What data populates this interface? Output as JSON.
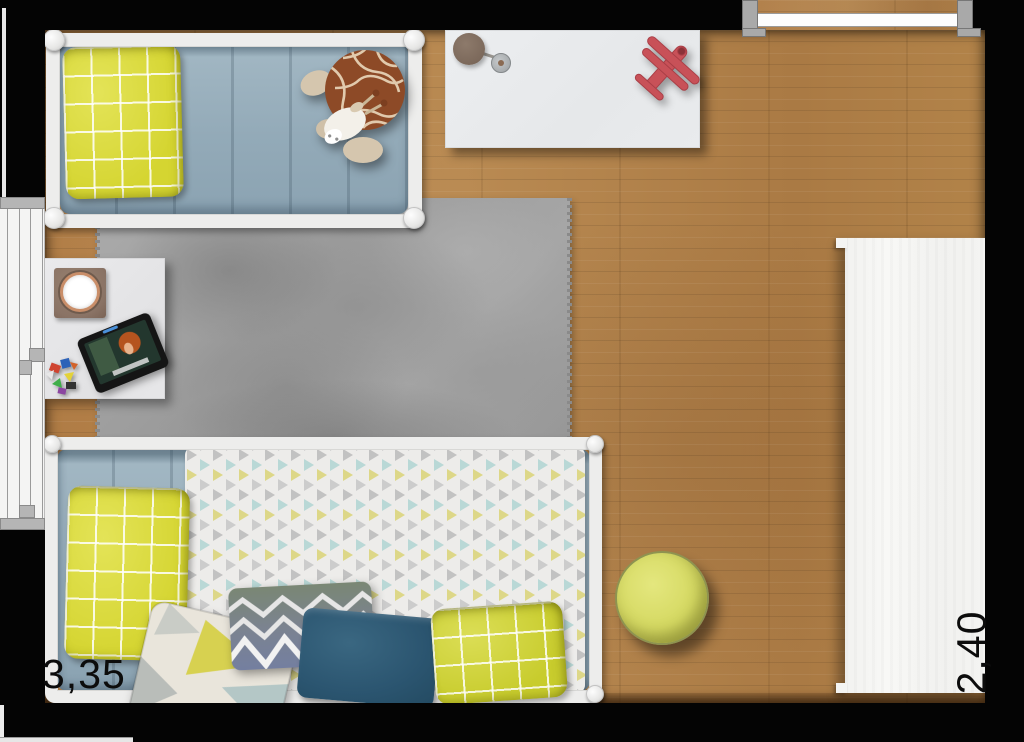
{
  "labels": {
    "room_width": "3,35",
    "room_depth": "2,40"
  },
  "palette": {
    "wall": "#040404",
    "floor_wood": "#b2814a",
    "rug_gray": "#a2a2a2",
    "bed_frame_white": "#ededec",
    "bedding_blue": "#93aab8",
    "pillow_yellow": "#d5d531",
    "pillow_navy": "#2d5670",
    "duvet_triangle_base": "#edecea",
    "triangle_gray": "#c2c2c2",
    "triangle_yellow": "#ddd788",
    "triangle_blue": "#b9d8d6",
    "pouf_yellow": "#d5d962",
    "furniture_white": "#eceef0",
    "wardrobe_white": "#f4f4f2",
    "airplane_red": "#c85158",
    "lamp_shade_brown": "#7c695b",
    "giraffe_brown": "#8d4a27",
    "window_frame": "#f4f4f3",
    "door_leaf": "#fdfdfd"
  },
  "furniture": [
    {
      "name": "toddler-bed"
    },
    {
      "name": "giraffe-plush-toy"
    },
    {
      "name": "desk"
    },
    {
      "name": "desk-lamp"
    },
    {
      "name": "toy-airplane"
    },
    {
      "name": "nightstand"
    },
    {
      "name": "drum-toy"
    },
    {
      "name": "tablet"
    },
    {
      "name": "toy-blocks"
    },
    {
      "name": "rug"
    },
    {
      "name": "daybed"
    },
    {
      "name": "triangle-duvet"
    },
    {
      "name": "chevron-pillow"
    },
    {
      "name": "navy-pillow"
    },
    {
      "name": "yellow-grid-pillow"
    },
    {
      "name": "triangle-accent-pillow"
    },
    {
      "name": "pouf"
    },
    {
      "name": "wardrobe"
    },
    {
      "name": "window"
    },
    {
      "name": "door"
    }
  ]
}
